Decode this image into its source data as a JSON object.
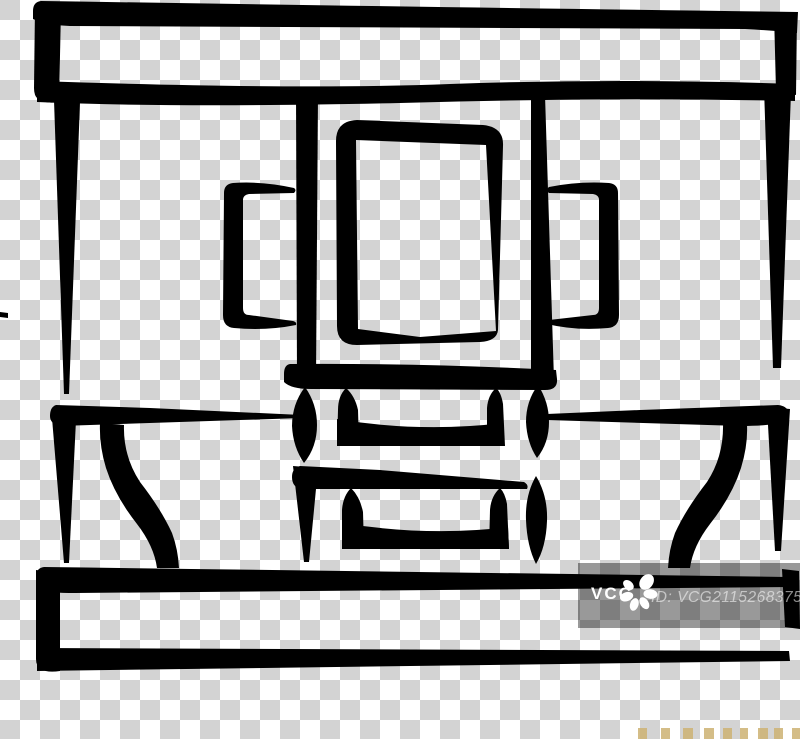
{
  "watermark": {
    "brand": "VCG",
    "id_text": "ID: VCG211526837544"
  },
  "colors": {
    "ink": "#000000",
    "checker-light": "#ffffff",
    "checker-dark": "#d3d3d3",
    "wm-band": "rgba(0,0,0,0.40)",
    "wm-text": "rgba(255,255,255,0.55)",
    "wm-brand": "#ffffff",
    "mark-tan": "#cdb272"
  }
}
